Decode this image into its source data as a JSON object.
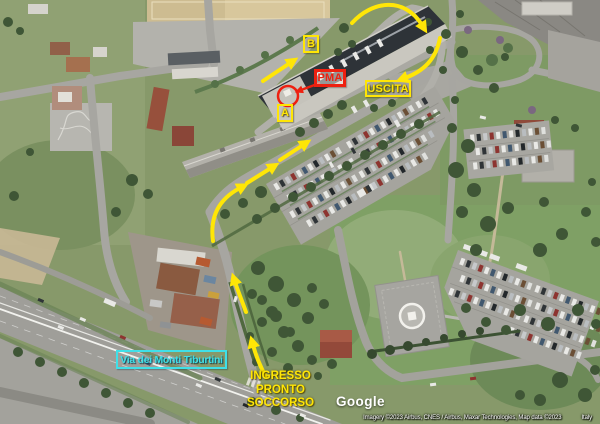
{
  "map": {
    "markers": {
      "b": "B",
      "a": "A",
      "pma": "PMA",
      "uscita": "USCITA"
    },
    "street_label": "Via dei Monti Tiburtini",
    "entrance_label_lines": [
      "INGRESSO",
      "PRONTO",
      "SOCCORSO"
    ],
    "colors": {
      "route_yellow": "#ffe606",
      "alert_red": "#ee2010",
      "street_cyan": "#3fe0e8"
    }
  },
  "watermark": {
    "logo": "Google"
  },
  "attribution": {
    "imagery_credit": "Imagery ©2023 Airbus, CNES / Airbus, Maxar Technologies, Map data ©2023",
    "region_label": "Italy"
  }
}
